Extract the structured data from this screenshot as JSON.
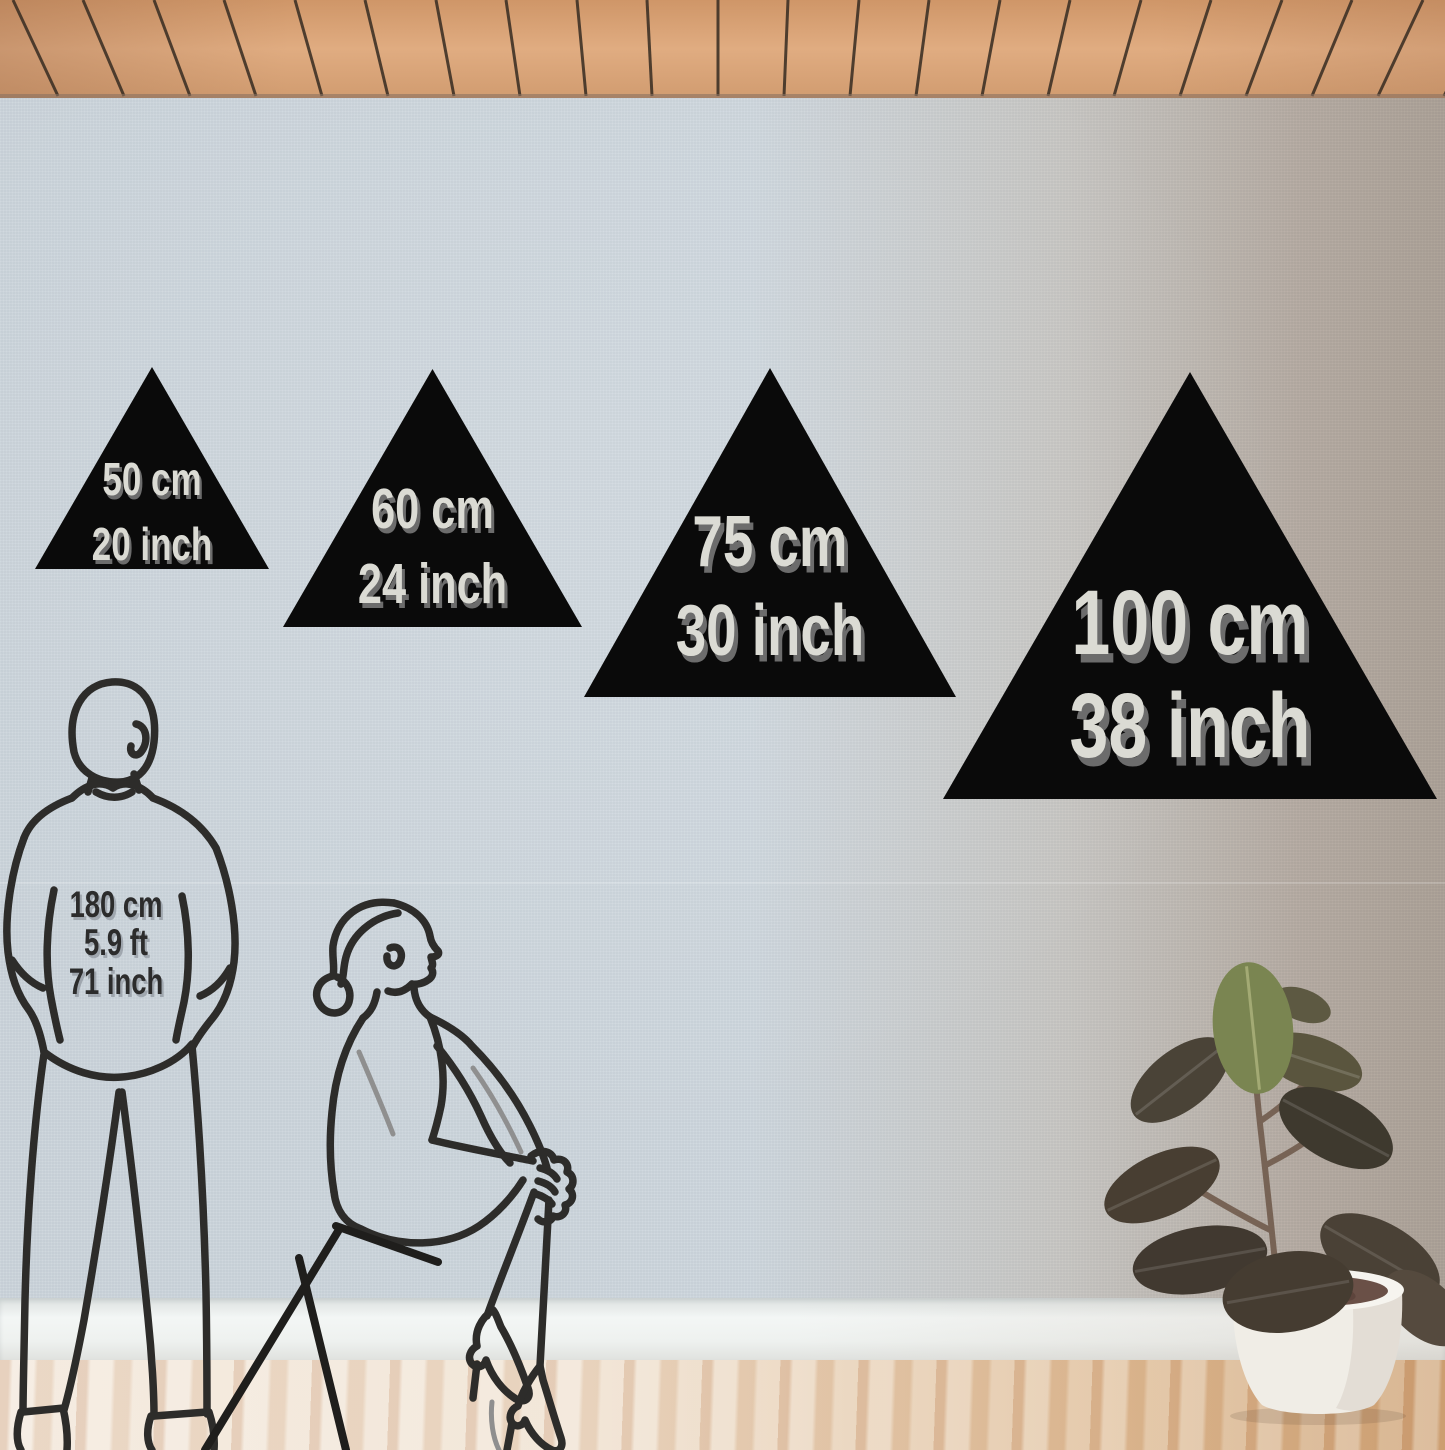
{
  "product_size_chart": {
    "triangles": [
      {
        "name": "size-50cm",
        "cm": "50 cm",
        "inch": "20 inch"
      },
      {
        "name": "size-60cm",
        "cm": "60 cm",
        "inch": "24 inch"
      },
      {
        "name": "size-75cm",
        "cm": "75 cm",
        "inch": "30 inch"
      },
      {
        "name": "size-100cm",
        "cm": "100 cm",
        "inch": "38 inch"
      }
    ],
    "reference_person": {
      "height_cm": "180 cm",
      "height_ft": "5.9 ft",
      "height_in": "71 inch"
    }
  },
  "colors": {
    "triangle_fill": "#0a0a0a",
    "triangle_label": "#dbdbd4",
    "triangle_label_shadow": "#6c6c6c",
    "person_label": "#2c2c2c",
    "line_art": "#2d2c2a",
    "wall_left": "#cdd6dd",
    "wall_right": "#a89c91",
    "ceiling_wood": "#d9a478",
    "ceiling_groove": "#3b2f24",
    "baseboard": "#f3f6f5",
    "floor_left": "#f2e6d8",
    "floor_right": "#cda173",
    "plant_leaf_dark": "#463d31",
    "plant_leaf_green": "#7a8551",
    "pot": "#f4f2ed"
  }
}
